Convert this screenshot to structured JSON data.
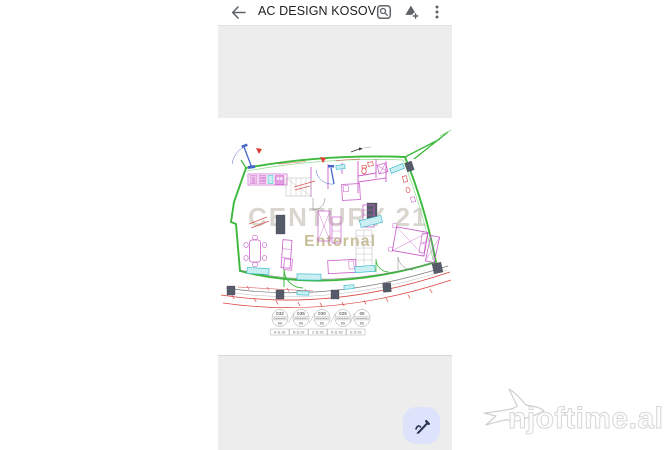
{
  "topbar": {
    "title": "AC DESIGN KOSOV...",
    "icons": {
      "back": "arrow-left-icon",
      "search_doc": "find-in-page-icon",
      "drive": "add-to-drive-icon",
      "menu": "more-vert-icon"
    }
  },
  "plan": {
    "watermark": {
      "line1": "CENTURY 21",
      "line2": "Enternal"
    },
    "legend": {
      "badges": [
        {
          "value": "032",
          "sub": "BB"
        },
        {
          "value": "035",
          "sub": "BB"
        },
        {
          "value": "030",
          "sub": "BB"
        },
        {
          "value": "025",
          "sub": "BB"
        },
        {
          "value": "00",
          "sub": "BB"
        }
      ],
      "labels": [
        "A-11-02",
        "B-11-02",
        "C-11-02",
        "D-11-02",
        "E-11-02"
      ]
    }
  },
  "fab": {
    "icon": "stylus-pen-icon"
  },
  "brand": {
    "text": "njoftime.al",
    "icon": "swallow-bird-icon"
  },
  "colors": {
    "wall_green": "#3cb93c",
    "furniture_magenta": "#c95fc9",
    "accent_cyan": "#2ab6c8",
    "dimension_red": "#d9423f",
    "door_blue": "#4566c8",
    "column_gray": "#565b69",
    "fab_bg": "#dde3fb",
    "fab_icon": "#2a3350",
    "viewer_gray": "#ededee",
    "watermark_gray": "#d9d6d0",
    "watermark_tan": "#c9c19a"
  }
}
